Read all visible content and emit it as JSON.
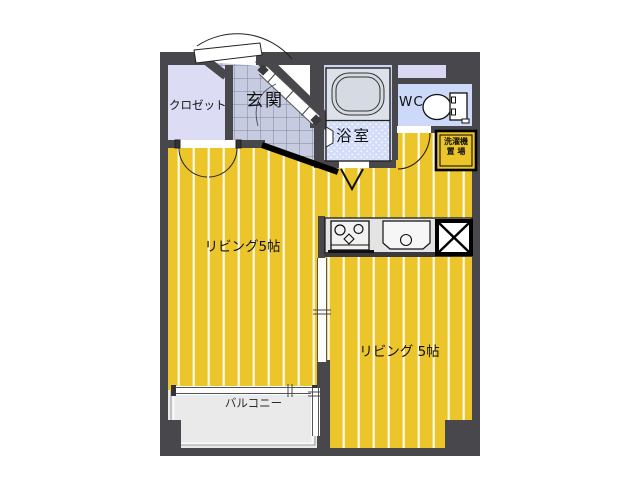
{
  "title": "1LDK-style apartment floor plan",
  "rooms": {
    "closet": {
      "label": "クロゼット"
    },
    "entrance": {
      "label": "玄関"
    },
    "bathroom": {
      "label": "浴室"
    },
    "toilet": {
      "label": "WC"
    },
    "washer_space": {
      "label_line1": "洗濯機",
      "label_line2": "置 場"
    },
    "living_left": {
      "label": "リビング5帖"
    },
    "living_right": {
      "label": "リビング 5帖"
    },
    "balcony": {
      "label": "バルコニー"
    }
  },
  "icons": [
    "bathtub-icon",
    "toilet-icon",
    "stove-icon",
    "sink-icon",
    "refrigerator-space-icon",
    "entrance-door-icon",
    "closet-double-door-icon",
    "wc-door-arc-icon",
    "folding-door-icon",
    "window-band",
    "step-edge"
  ],
  "colors": {
    "wall": "#48484c",
    "floor_yellow": "#ecc52b",
    "floor_stripe": "#fdfbe8",
    "closet_lavender": "#dcdcf4",
    "pipe_band_lavender": "#d8d8f2",
    "entrance_tile": "#c6cbdf",
    "tile_grid_line": "#7e84a0",
    "bath_background": "#ccd4f1",
    "wc_background": "#cdd9f8",
    "washroom_stipple": "#d3ddfa",
    "bath_unit_gray": "#dde2ea",
    "counter_gray": "#e4e4e4",
    "balcony_gray": "#eaeaea",
    "line_black": "#111111"
  }
}
